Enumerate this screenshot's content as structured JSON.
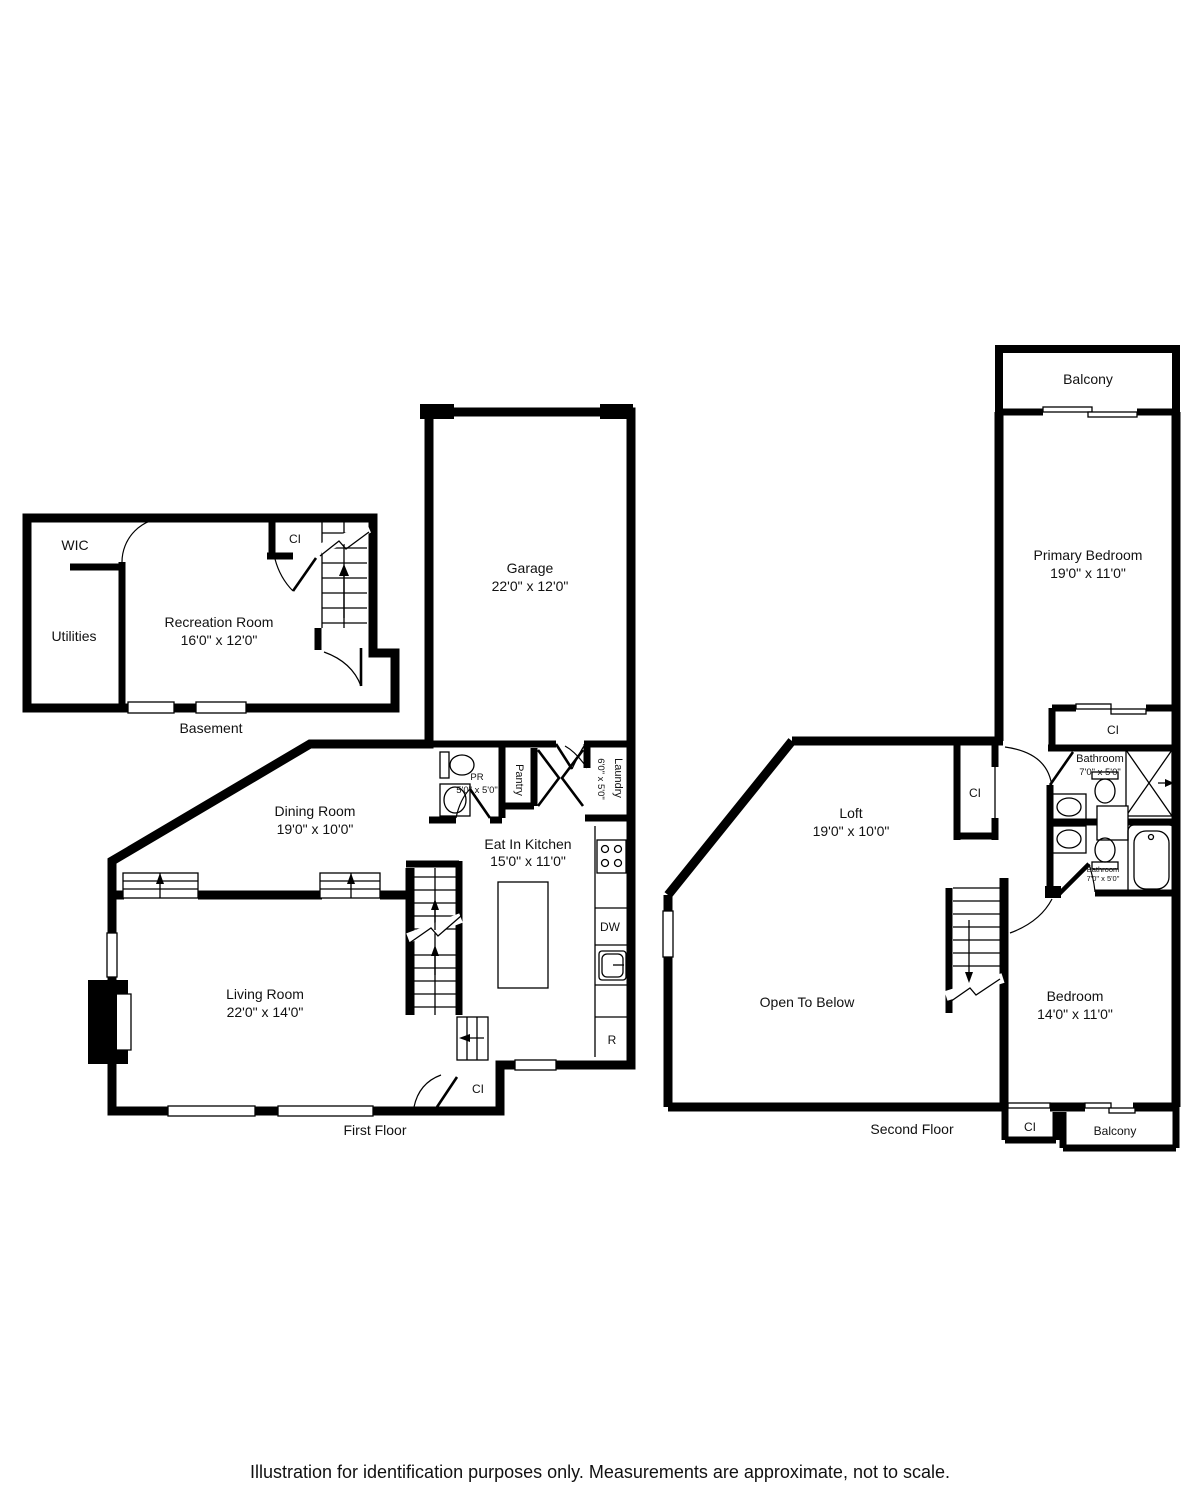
{
  "caption": "Illustration for identification purposes only. Measurements are approximate, not to scale.",
  "colors": {
    "wall": "#000000",
    "background": "#ffffff",
    "text": "#111111"
  },
  "plans": {
    "basement": {
      "title": "Basement",
      "wic": "WIC",
      "utilities": "Utilities",
      "recreation": "Recreation Room",
      "recreation_dims": "16'0\" x 12'0\"",
      "closet": "CI"
    },
    "first": {
      "title": "First Floor",
      "garage": "Garage",
      "garage_dims": "22'0\" x 12'0\"",
      "powder": "PR",
      "powder_dims": "5'0\" x 5'0\"",
      "pantry": "Pantry",
      "laundry": "Laundry",
      "laundry_dims": "6'0\" x 5'0\"",
      "dining": "Dining Room",
      "dining_dims": "19'0\" x 10'0\"",
      "kitchen": "Eat In Kitchen",
      "kitchen_dims": "15'0\" x 11'0\"",
      "dishwasher": "DW",
      "refrigerator": "R",
      "living": "Living Room",
      "living_dims": "22'0\" x 14'0\"",
      "closet": "CI"
    },
    "second": {
      "title": "Second Floor",
      "balcony_top": "Balcony",
      "primary": "Primary Bedroom",
      "primary_dims": "19'0\" x 11'0\"",
      "primary_closet": "CI",
      "bath1": "Bathroom",
      "bath1_dims": "7'0\" x 5'0\"",
      "loft_closet": "CI",
      "loft": "Loft",
      "loft_dims": "19'0\" x 10'0\"",
      "bath2": "Bathroom",
      "bath2_dims": "7'0\" x 5'0\"",
      "open_below": "Open To Below",
      "bedroom": "Bedroom",
      "bedroom_dims": "14'0\" x 11'0\"",
      "bottom_closet": "CI",
      "balcony_bottom": "Balcony"
    }
  }
}
